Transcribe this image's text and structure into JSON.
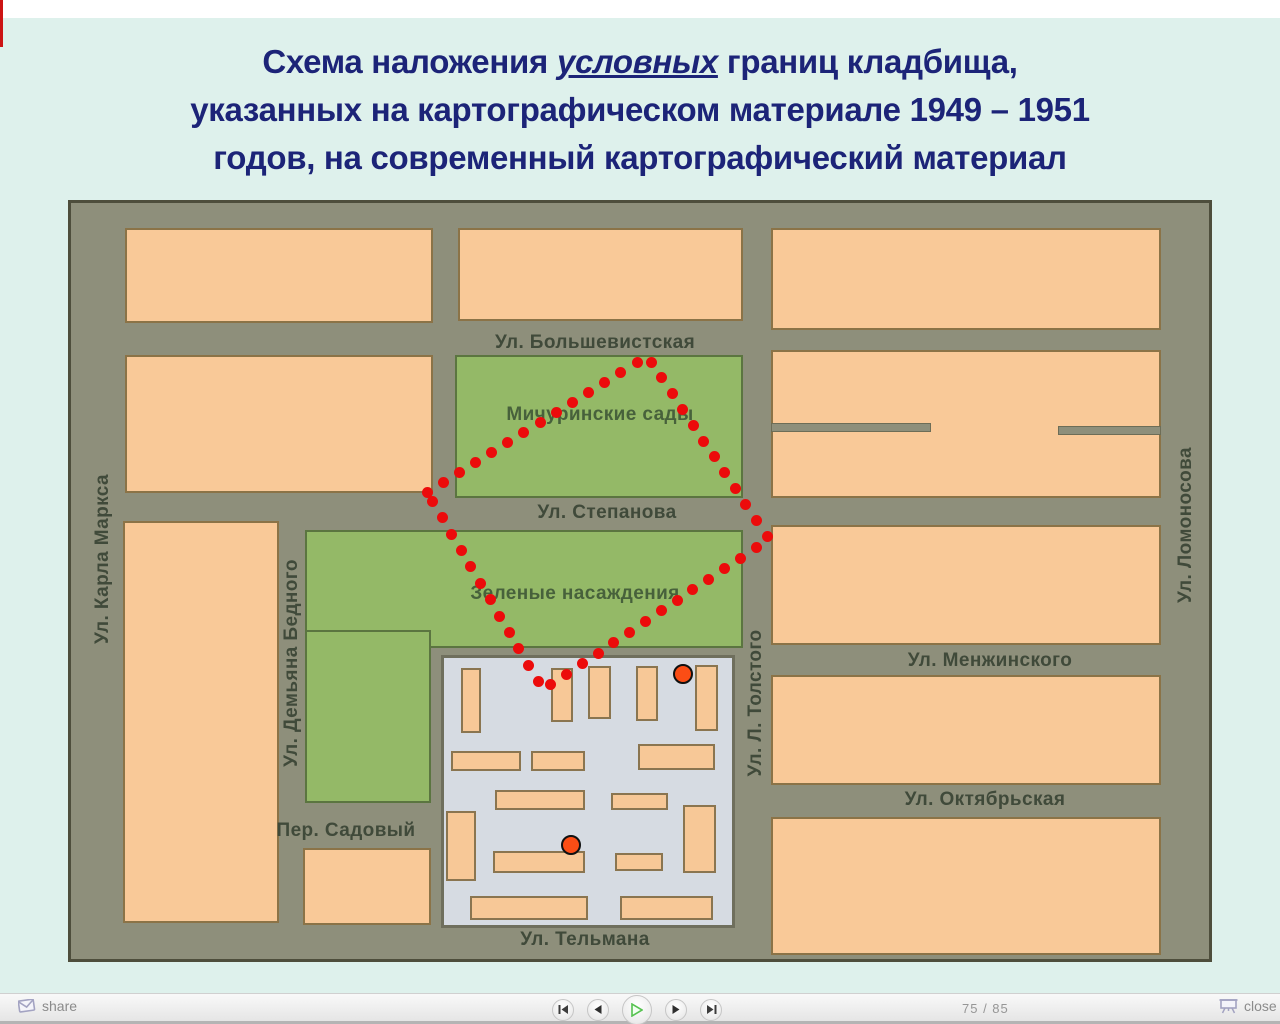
{
  "page": {
    "bg_color": "#def1ec",
    "accent_red": "#cc1414"
  },
  "title": {
    "color": "#1c2478",
    "line1_pre": "Схема наложения",
    "line1_em": "условных",
    "line1_post": "границ кладбища,",
    "line2": "указанных на картографическом материале 1949 – 1951",
    "line3": "годов, на современный картографический материал"
  },
  "map": {
    "colors": {
      "street_bg": "#8e8f7b",
      "block_fill": "#f9c998",
      "block_border": "#8b7347",
      "green_fill": "#94b967",
      "green_border": "#5b7540",
      "residential_fill": "#d6dbe2",
      "boundary_dot": "#ec0b0b",
      "marker_fill": "#fb4d15"
    },
    "blocks": [
      {
        "name": "block-nw-1",
        "kind": "peach",
        "x": 54,
        "y": 25,
        "w": 308,
        "h": 95
      },
      {
        "name": "block-nw-2",
        "kind": "peach",
        "x": 54,
        "y": 152,
        "w": 308,
        "h": 138
      },
      {
        "name": "block-west-tall",
        "kind": "peach",
        "x": 52,
        "y": 318,
        "w": 156,
        "h": 402
      },
      {
        "name": "block-sadovy",
        "kind": "peach",
        "x": 232,
        "y": 645,
        "w": 128,
        "h": 77
      },
      {
        "name": "block-north-center",
        "kind": "peach",
        "x": 387,
        "y": 25,
        "w": 285,
        "h": 93
      },
      {
        "name": "block-ne-1",
        "kind": "peach",
        "x": 700,
        "y": 25,
        "w": 390,
        "h": 102
      },
      {
        "name": "block-ne-2",
        "kind": "peach",
        "x": 700,
        "y": 147,
        "w": 390,
        "h": 148
      },
      {
        "name": "block-east-3",
        "kind": "peach",
        "x": 700,
        "y": 322,
        "w": 390,
        "h": 120
      },
      {
        "name": "block-east-4",
        "kind": "peach",
        "x": 700,
        "y": 472,
        "w": 390,
        "h": 110
      },
      {
        "name": "block-east-5",
        "kind": "peach",
        "x": 700,
        "y": 614,
        "w": 390,
        "h": 138
      },
      {
        "name": "green-michurinskie",
        "kind": "green",
        "x": 384,
        "y": 152,
        "w": 288,
        "h": 143
      },
      {
        "name": "green-nasazhdeniya",
        "kind": "green",
        "x": 234,
        "y": 327,
        "w": 438,
        "h": 118
      },
      {
        "name": "green-nasazhdeniya-arm",
        "kind": "green",
        "x": 234,
        "y": 427,
        "w": 126,
        "h": 173
      }
    ],
    "cuts": [
      {
        "name": "lane-cut-left",
        "x": 700,
        "y": 220,
        "w": 160,
        "h": 9
      },
      {
        "name": "lane-cut-right",
        "x": 987,
        "y": 223,
        "w": 103,
        "h": 9
      }
    ],
    "residential": {
      "name": "residential-quarter",
      "x": 370,
      "y": 452,
      "w": 294,
      "h": 273,
      "buildings": [
        {
          "x": 390,
          "y": 465,
          "w": 20,
          "h": 65
        },
        {
          "x": 480,
          "y": 465,
          "w": 22,
          "h": 54
        },
        {
          "x": 517,
          "y": 463,
          "w": 23,
          "h": 53
        },
        {
          "x": 565,
          "y": 463,
          "w": 22,
          "h": 55
        },
        {
          "x": 624,
          "y": 462,
          "w": 23,
          "h": 66
        },
        {
          "x": 380,
          "y": 548,
          "w": 70,
          "h": 20
        },
        {
          "x": 460,
          "y": 548,
          "w": 54,
          "h": 20
        },
        {
          "x": 567,
          "y": 541,
          "w": 77,
          "h": 26
        },
        {
          "x": 424,
          "y": 587,
          "w": 90,
          "h": 20
        },
        {
          "x": 540,
          "y": 590,
          "w": 57,
          "h": 17
        },
        {
          "x": 375,
          "y": 608,
          "w": 30,
          "h": 70
        },
        {
          "x": 422,
          "y": 648,
          "w": 92,
          "h": 22
        },
        {
          "x": 544,
          "y": 650,
          "w": 48,
          "h": 18
        },
        {
          "x": 612,
          "y": 602,
          "w": 33,
          "h": 68
        },
        {
          "x": 399,
          "y": 693,
          "w": 118,
          "h": 24
        },
        {
          "x": 549,
          "y": 693,
          "w": 93,
          "h": 24
        }
      ]
    },
    "labels": [
      {
        "name": "street-bolshevistskaya",
        "text": "Ул. Большевистская",
        "x": 524,
        "y": 140,
        "rot": false
      },
      {
        "name": "street-stepanova",
        "text": "Ул. Степанова",
        "x": 536,
        "y": 310,
        "rot": false
      },
      {
        "name": "street-menzhinskogo",
        "text": "Ул. Менжинского",
        "x": 919,
        "y": 458,
        "rot": false
      },
      {
        "name": "street-oktyabrskaya",
        "text": "Ул. Октябрьская",
        "x": 914,
        "y": 597,
        "rot": false
      },
      {
        "name": "street-telmana",
        "text": "Ул. Тельмана",
        "x": 514,
        "y": 737,
        "rot": false
      },
      {
        "name": "street-sadovy",
        "text": "Пер. Садовый",
        "x": 275,
        "y": 628,
        "rot": false
      },
      {
        "name": "street-karla-marksa",
        "text": "Ул. Карла Маркса",
        "x": 32,
        "y": 356,
        "rot": true
      },
      {
        "name": "street-demyana-bednogo",
        "text": "Ул. Демьяна Бедного",
        "x": 221,
        "y": 460,
        "rot": true
      },
      {
        "name": "street-l-tolstogo",
        "text": "Ул. Л. Толстого",
        "x": 685,
        "y": 500,
        "rot": true
      },
      {
        "name": "street-lomonosova",
        "text": "Ул. Ломоносова",
        "x": 1115,
        "y": 322,
        "rot": true
      },
      {
        "name": "area-michurinskie-sady",
        "text": "Мичуринские сады",
        "x": 529,
        "y": 212,
        "rot": false,
        "area": true
      },
      {
        "name": "area-zelenye-nasazhdeniya",
        "text": "Зеленые насаждения",
        "x": 504,
        "y": 391,
        "rot": false,
        "area": true
      }
    ],
    "boundary": {
      "vertices": [
        [
          356,
          289
        ],
        [
          576,
          153
        ],
        [
          698,
          336
        ],
        [
          472,
          487
        ]
      ],
      "dot_spacing": 19,
      "dot_radius": 5.5
    },
    "markers": [
      {
        "name": "cemetery-marker-1",
        "x": 612,
        "y": 471,
        "r": 10
      },
      {
        "name": "cemetery-marker-2",
        "x": 500,
        "y": 642,
        "r": 10
      }
    ]
  },
  "toolbar": {
    "share_label": "share",
    "close_label": "close",
    "page_counter": "75 / 85",
    "buttons": [
      {
        "name": "first-slide-button"
      },
      {
        "name": "previous-slide-button"
      },
      {
        "name": "play-button"
      },
      {
        "name": "next-slide-button"
      },
      {
        "name": "last-slide-button"
      }
    ]
  }
}
